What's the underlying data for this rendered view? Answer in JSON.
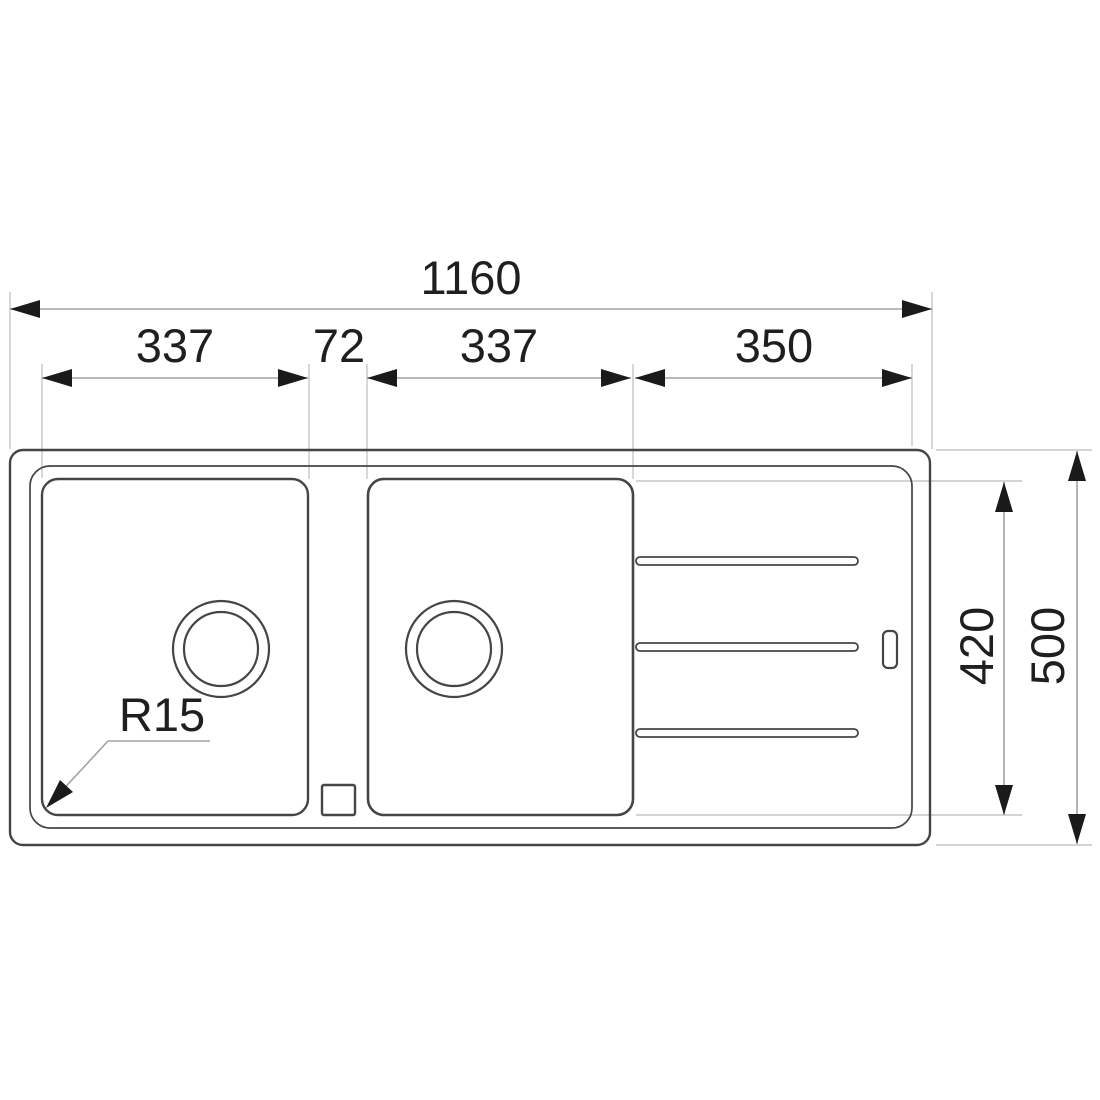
{
  "drawing": {
    "type": "sink-top-view-technical-drawing",
    "colors": {
      "background": "#ffffff",
      "outline": "#454545",
      "outline_light": "#555555",
      "dimension_line": "#a2a2a2",
      "extension_line": "#c6c6c6",
      "arrow": "#1a1a1a",
      "text": "#1f1f1f"
    },
    "dimensions": {
      "overall_width": {
        "label": "1160"
      },
      "left_bowl_width": {
        "label": "337"
      },
      "divider_width": {
        "label": "72"
      },
      "right_bowl_width": {
        "label": "337"
      },
      "drainer_width": {
        "label": "350"
      },
      "bowl_depth": {
        "label": "420"
      },
      "overall_depth": {
        "label": "500"
      },
      "corner_radius": {
        "label": "R15"
      }
    }
  }
}
